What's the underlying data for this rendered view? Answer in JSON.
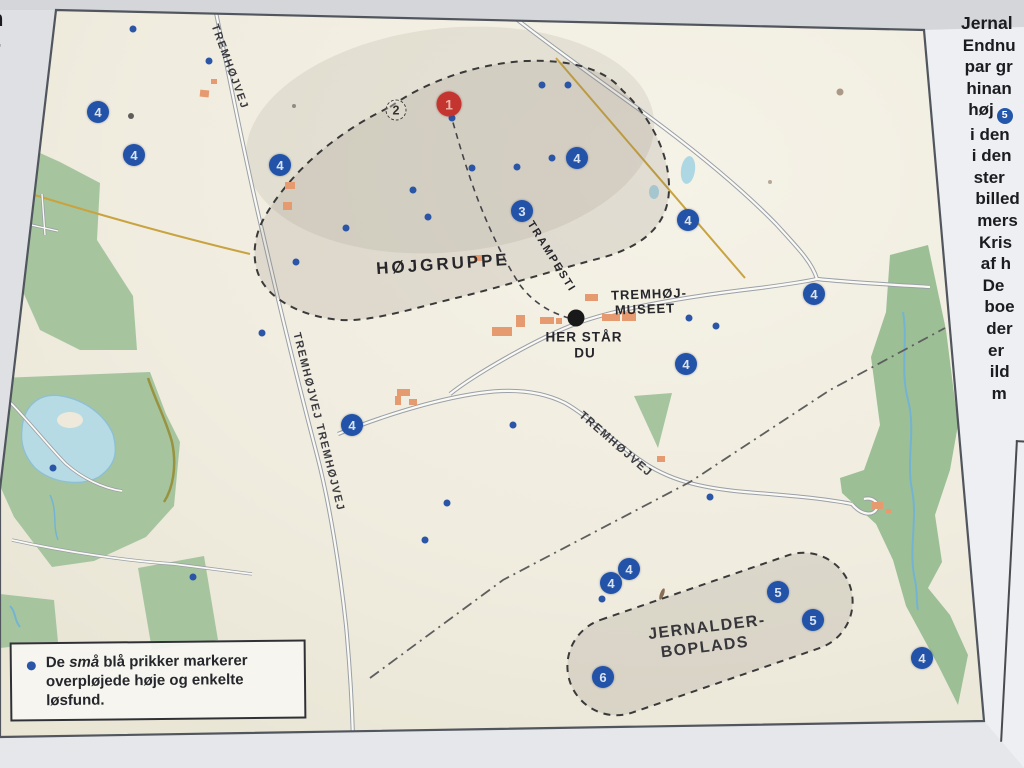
{
  "map": {
    "area_labels": {
      "hojgruppe": "HØJGRUPPE",
      "jernalder_line1": "JERNALDER-",
      "jernalder_line2": "BOPLADS"
    },
    "poi_labels": {
      "museum_line1": "TREMHØJ-",
      "museum_line2": "MUSEET",
      "you_are_here_line1": "HER STÅR",
      "you_are_here_line2": "DU"
    },
    "road_labels": {
      "nw": "TREMHØJVEJ",
      "w": "TREMHØJVEJ TREMHØJVEJ",
      "e": "TREMHØJVEJ",
      "path": "TRAMPESTI"
    },
    "colors": {
      "marker_blue": "#2353a8",
      "marker_red": "#c5352f",
      "forest_green": "#a6c59f",
      "lake_blue": "#b7dbe5",
      "board_cream": "#f0ecdf"
    },
    "markers": [
      {
        "label": "1",
        "x": 449,
        "y": 104,
        "variant": "red"
      },
      {
        "label": "2",
        "x": 396,
        "y": 110,
        "variant": "dashed"
      },
      {
        "label": "3",
        "x": 522,
        "y": 211,
        "variant": "blue"
      },
      {
        "label": "4",
        "x": 98,
        "y": 112,
        "variant": "blue"
      },
      {
        "label": "4",
        "x": 134,
        "y": 155,
        "variant": "blue"
      },
      {
        "label": "4",
        "x": 280,
        "y": 165,
        "variant": "blue"
      },
      {
        "label": "4",
        "x": 577,
        "y": 158,
        "variant": "blue"
      },
      {
        "label": "4",
        "x": 688,
        "y": 220,
        "variant": "blue"
      },
      {
        "label": "4",
        "x": 814,
        "y": 294,
        "variant": "blue"
      },
      {
        "label": "4",
        "x": 352,
        "y": 425,
        "variant": "blue"
      },
      {
        "label": "4",
        "x": 686,
        "y": 364,
        "variant": "blue"
      },
      {
        "label": "4",
        "x": 629,
        "y": 569,
        "variant": "blue"
      },
      {
        "label": "4",
        "x": 611,
        "y": 583,
        "variant": "blue"
      },
      {
        "label": "4",
        "x": 922,
        "y": 658,
        "variant": "blue"
      },
      {
        "label": "5",
        "x": 778,
        "y": 592,
        "variant": "blue"
      },
      {
        "label": "5",
        "x": 813,
        "y": 620,
        "variant": "blue"
      },
      {
        "label": "6",
        "x": 603,
        "y": 677,
        "variant": "blue"
      }
    ],
    "dots": [
      [
        133,
        29
      ],
      [
        209,
        61
      ],
      [
        452,
        118
      ],
      [
        542,
        85
      ],
      [
        568,
        85
      ],
      [
        472,
        168
      ],
      [
        517,
        167
      ],
      [
        552,
        158
      ],
      [
        413,
        190
      ],
      [
        428,
        217
      ],
      [
        346,
        228
      ],
      [
        296,
        262
      ],
      [
        689,
        318
      ],
      [
        716,
        326
      ],
      [
        513,
        425
      ],
      [
        447,
        503
      ],
      [
        425,
        540
      ],
      [
        193,
        577
      ],
      [
        602,
        599
      ],
      [
        53,
        468
      ],
      [
        710,
        497
      ],
      [
        262,
        333
      ]
    ]
  },
  "legend": {
    "text_prefix": "De ",
    "text_italic": "små",
    "text_suffix": " blå prikker markerer overpløjede høje og enkelte løsfund.",
    "bullet_color": "#2b55a6"
  },
  "side_text": {
    "lines": [
      "Jernal",
      "Endnu",
      "par gr",
      "hinan",
      "høj",
      "i den",
      "i den",
      "ster",
      "billed",
      "mers",
      "Kris",
      "af h",
      "De",
      "boe",
      "der",
      "er",
      "ild",
      "m"
    ],
    "badge_line_index": 4,
    "badge_label": "5"
  },
  "edge_fragments": {
    "letter_top": "n",
    "letter_bottom": "r"
  }
}
